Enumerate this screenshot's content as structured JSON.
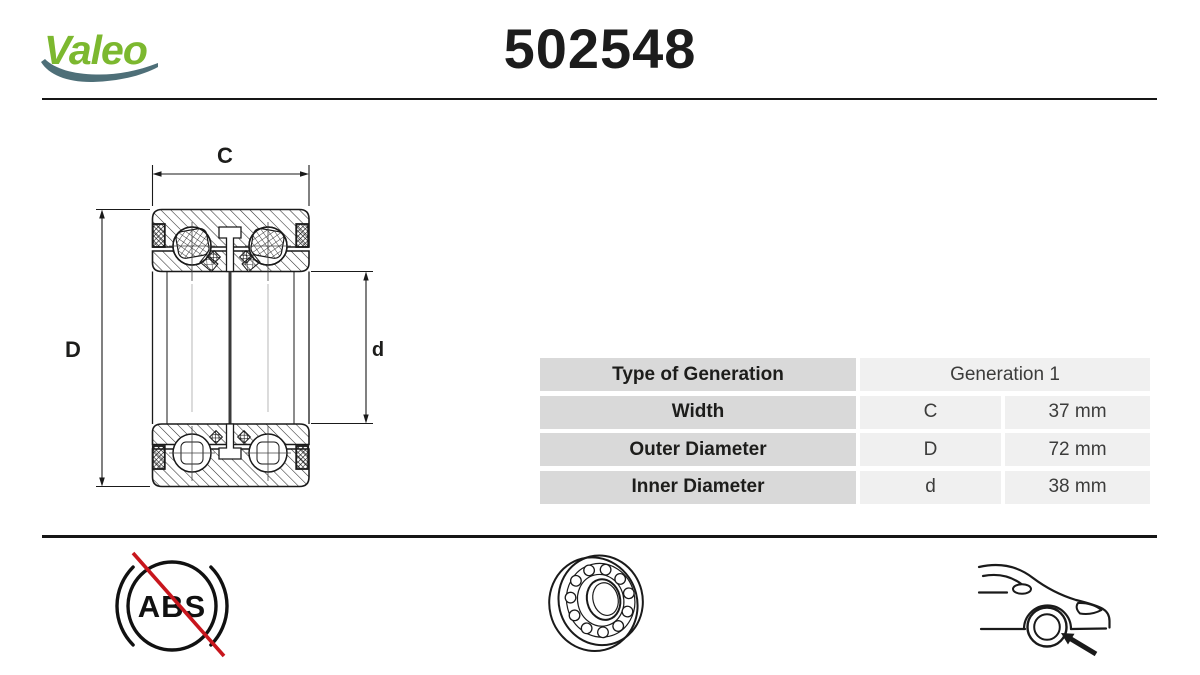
{
  "brand": {
    "name": "Valeo",
    "green": "#7cb82f",
    "swoosh_teal": "#4e6f78"
  },
  "part": {
    "number": "502548"
  },
  "diagram": {
    "type": "bearing-cross-section",
    "dim_width_label": "C",
    "dim_outer_label": "D",
    "dim_inner_label": "d"
  },
  "spec_table": {
    "rows": [
      {
        "label": "Type of Generation",
        "symbol": "",
        "value": "Generation 1"
      },
      {
        "label": "Width",
        "symbol": "C",
        "value": "37 mm"
      },
      {
        "label": "Outer Diameter",
        "symbol": "D",
        "value": "72 mm"
      },
      {
        "label": "Inner Diameter",
        "symbol": "d",
        "value": "38 mm"
      }
    ],
    "label_bg": "#d9d9d9",
    "value_bg": "#f0f0f0"
  },
  "footer": {
    "abs_label": "ABS",
    "abs_crossed_out": true,
    "strike_red": "#c8161d",
    "icons": [
      "no-abs-icon",
      "wheel-bearing-icon",
      "car-front-wheel-icon"
    ]
  },
  "colors": {
    "line_black": "#1a1a1a",
    "divider": "#161616"
  }
}
